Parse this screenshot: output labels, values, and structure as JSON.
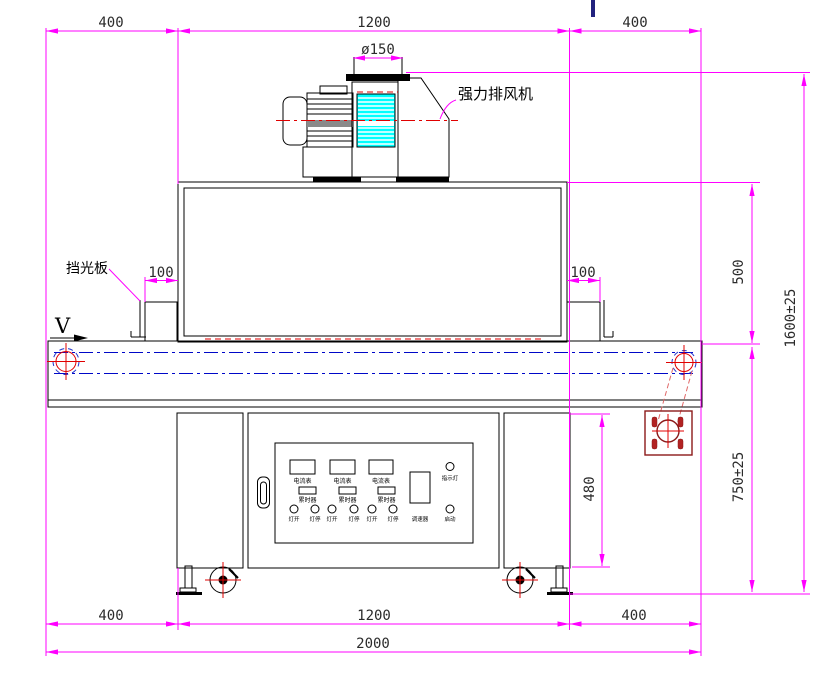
{
  "drawing_type": "engineering-dimension-drawing",
  "dims": {
    "top_left": "400",
    "top_middle": "1200",
    "top_right": "400",
    "duct_diameter": "ø150",
    "shield_left": "100",
    "shield_right": "100",
    "oven_height": "500",
    "total_height": "1600±25",
    "belt_height": "750±25",
    "base_height": "480",
    "bottom_left": "400",
    "bottom_middle": "1200",
    "bottom_right": "400",
    "total_width": "2000"
  },
  "callouts": {
    "exhaust_fan": "强力排风机",
    "light_shield": "挡光板",
    "belt_direction": "V"
  },
  "control_panel": {
    "meters": [
      "电流表",
      "电流表",
      "电流表"
    ],
    "timers": [
      "累时器",
      "累时器",
      "累时器"
    ],
    "lamp_buttons": [
      "灯开",
      "灯停",
      "灯开",
      "灯停",
      "灯开",
      "灯停"
    ],
    "speed_controller": "调速器",
    "indicator_light": "指示灯",
    "start": "启动"
  },
  "colors": {
    "dimension": "#ff00ff",
    "centerline_blue": "#0008c8",
    "centerline_red": "#e00000",
    "fan_block_fill": "#00ffff",
    "drive_bracket": "#8b1a1a",
    "outline": "#000000",
    "dim_text": "#2b2b2b",
    "top_tick": "#22227e"
  }
}
